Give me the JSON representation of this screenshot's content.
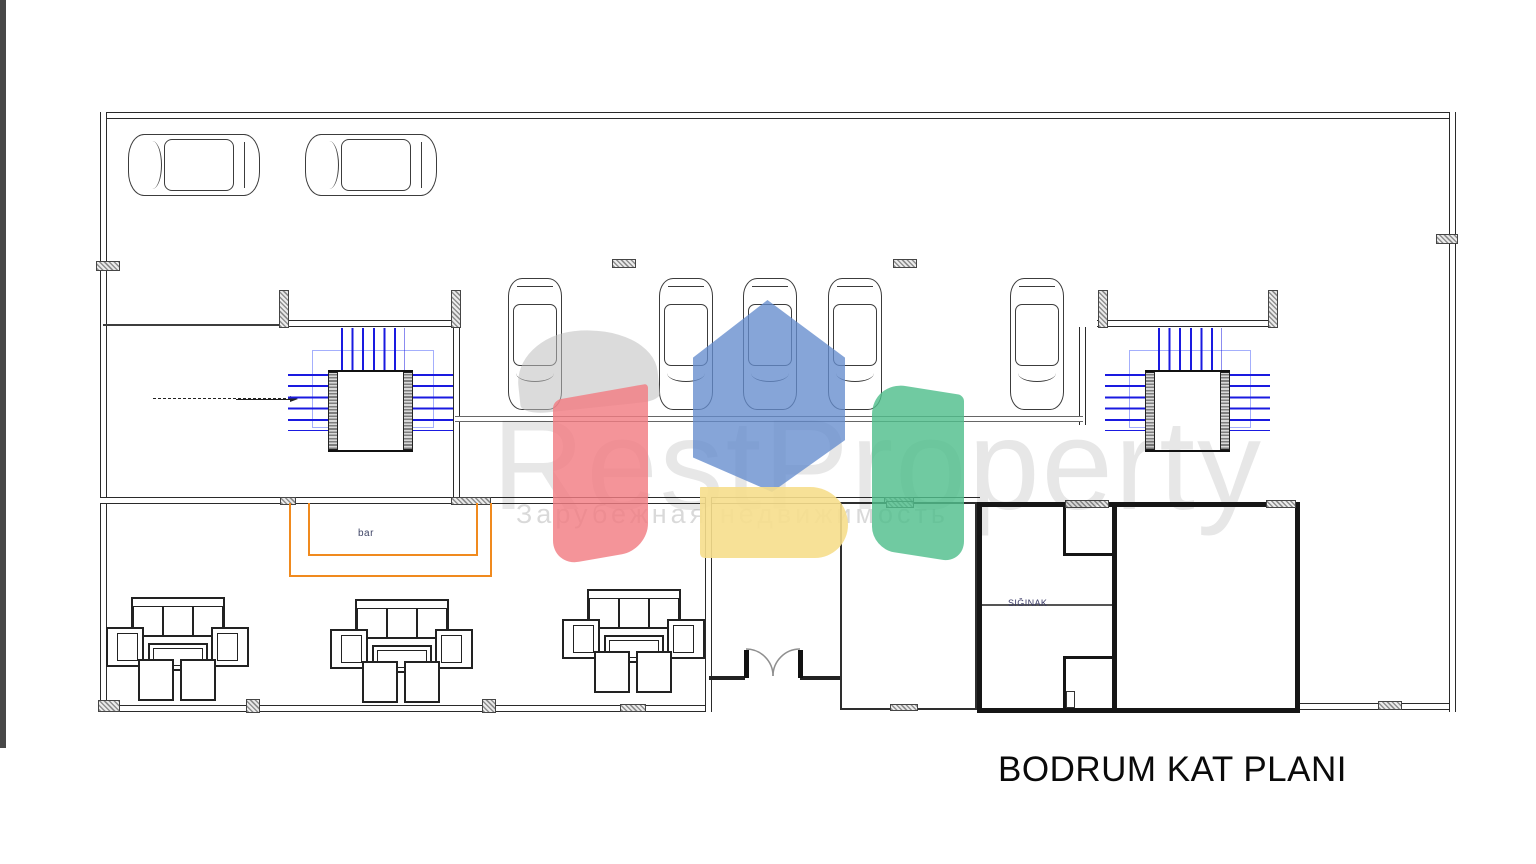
{
  "title": {
    "label": "BODRUM KAT PLANI"
  },
  "watermark": {
    "brand": "RestProperty",
    "subtitle": "Зарубежная недвижимость",
    "colors": {
      "red": "#f27d82",
      "blue": "#648cd0",
      "yellow": "#f6de8c",
      "green": "#50be8c",
      "gray": "#bebebe"
    }
  },
  "plan": {
    "bar_label": "bar",
    "shelter_label": "SIĞINAK",
    "stair_tread_color": "#1a1ae0",
    "bar_counter_color": "#f08a1e",
    "counts": {
      "cars_horizontal": 2,
      "cars_vertical": 5,
      "seating_groups": 3,
      "staircases": 2,
      "entrance_door_leaves": 2
    }
  }
}
